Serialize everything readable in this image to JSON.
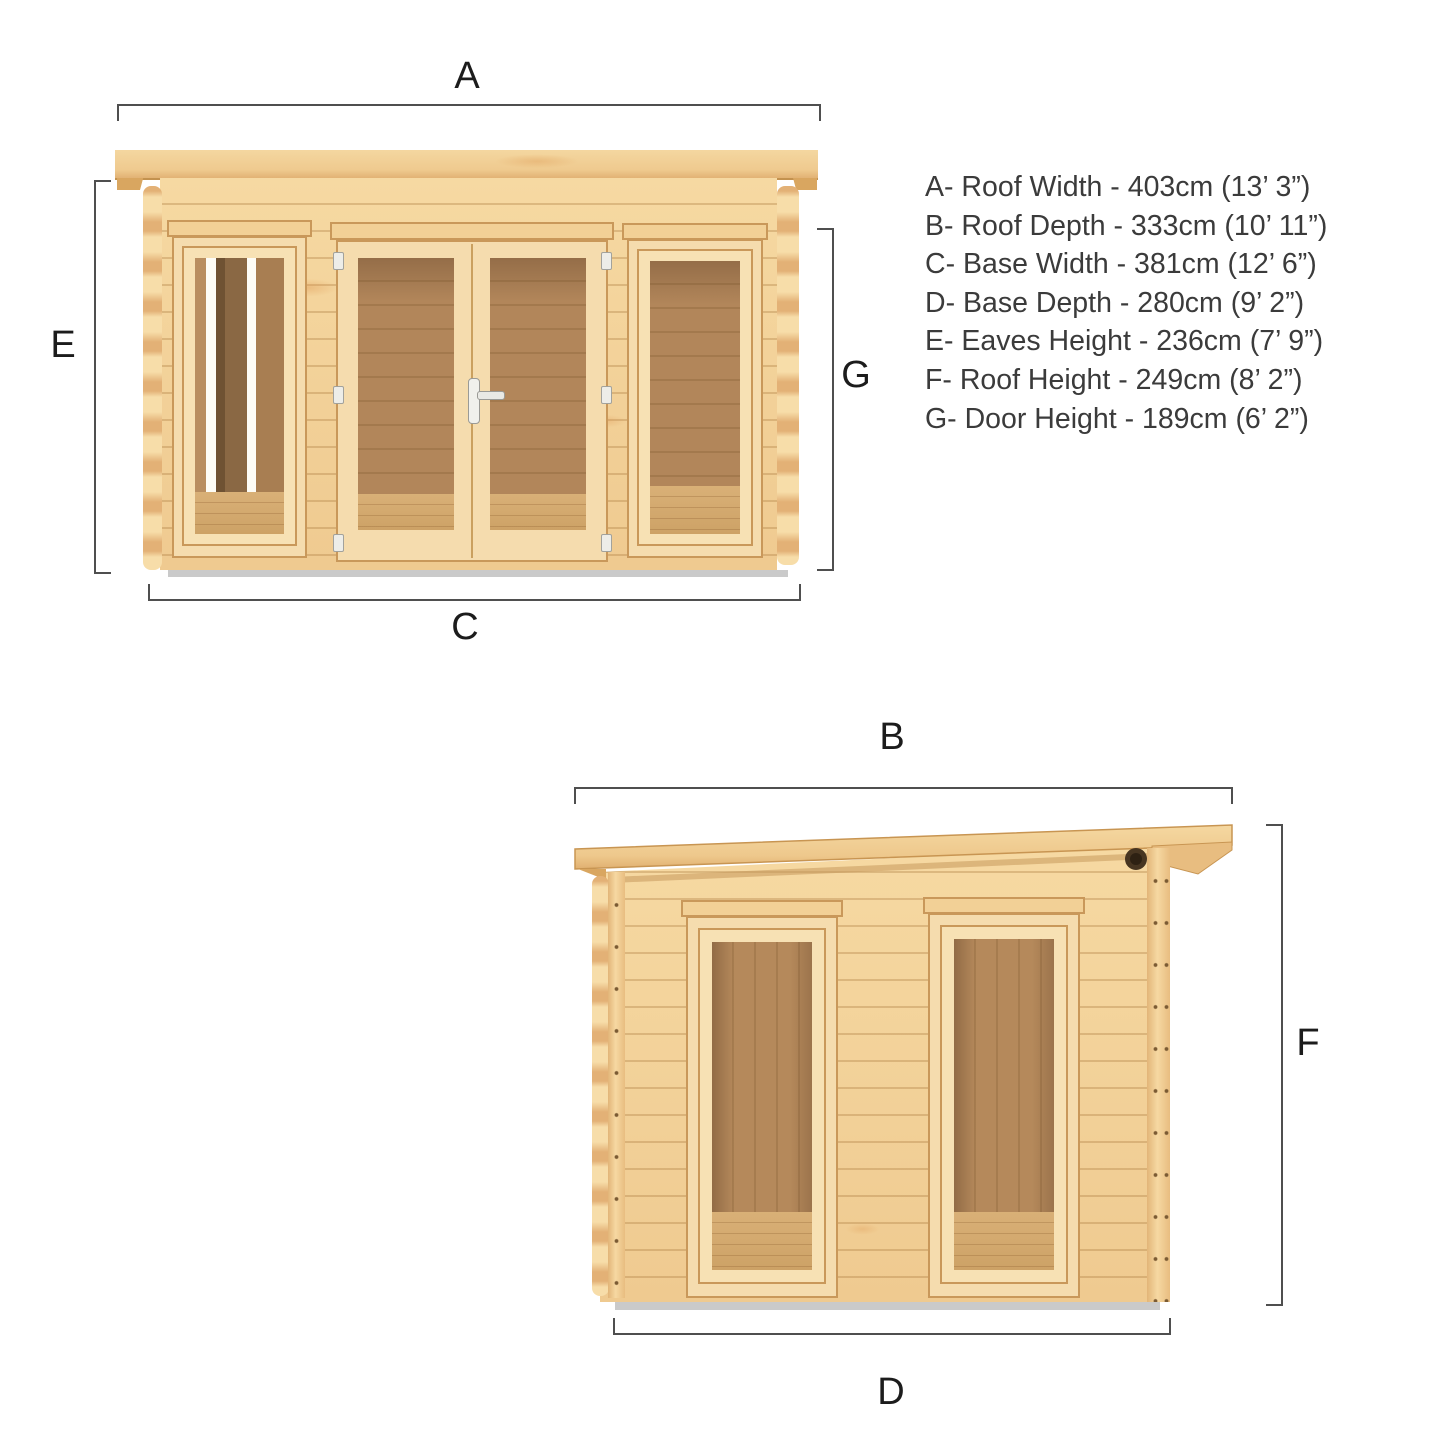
{
  "page": {
    "background": "#ffffff",
    "type": "product-dimension-diagram",
    "subject": "pent-roof log cabin with double doors and two front windows"
  },
  "colors": {
    "dimension_line": "#4f4f4f",
    "label_text": "#1c1c1c",
    "legend_text": "#3b3b3b",
    "wood_light": "#f2d098",
    "wood_mid": "#e9bd7e",
    "wood_trim": "#c9985a",
    "interior_wood": "#b2865a",
    "interior_floor": "#d6ad74",
    "base_shadow": "#cacaca"
  },
  "labels": {
    "a": "A",
    "b": "B",
    "c": "C",
    "d": "D",
    "e": "E",
    "f": "F",
    "g": "G"
  },
  "legend": {
    "items": [
      {
        "key": "A",
        "text": "A- Roof Width - 403cm (13’ 3”)"
      },
      {
        "key": "B",
        "text": "B- Roof Depth - 333cm (10’ 11”)"
      },
      {
        "key": "C",
        "text": "C- Base Width - 381cm (12’ 6”)"
      },
      {
        "key": "D",
        "text": "D- Base Depth - 280cm (9’ 2”)"
      },
      {
        "key": "E",
        "text": "E- Eaves Height - 236cm (7’ 9”)"
      },
      {
        "key": "F",
        "text": "F- Roof Height - 249cm (8’ 2”)"
      },
      {
        "key": "G",
        "text": "G- Door Height - 189cm (6’ 2”)"
      }
    ]
  },
  "dimensions": {
    "A": {
      "name": "Roof Width",
      "metric": "403cm",
      "imperial": "13’ 3”"
    },
    "B": {
      "name": "Roof Depth",
      "metric": "333cm",
      "imperial": "10’ 11”"
    },
    "C": {
      "name": "Base Width",
      "metric": "381cm",
      "imperial": "12’ 6”"
    },
    "D": {
      "name": "Base Depth",
      "metric": "280cm",
      "imperial": "9’ 2”"
    },
    "E": {
      "name": "Eaves Height",
      "metric": "236cm",
      "imperial": "7’ 9”"
    },
    "F": {
      "name": "Roof Height",
      "metric": "249cm",
      "imperial": "8’ 2”"
    },
    "G": {
      "name": "Door Height",
      "metric": "189cm",
      "imperial": "6’ 2”"
    }
  }
}
